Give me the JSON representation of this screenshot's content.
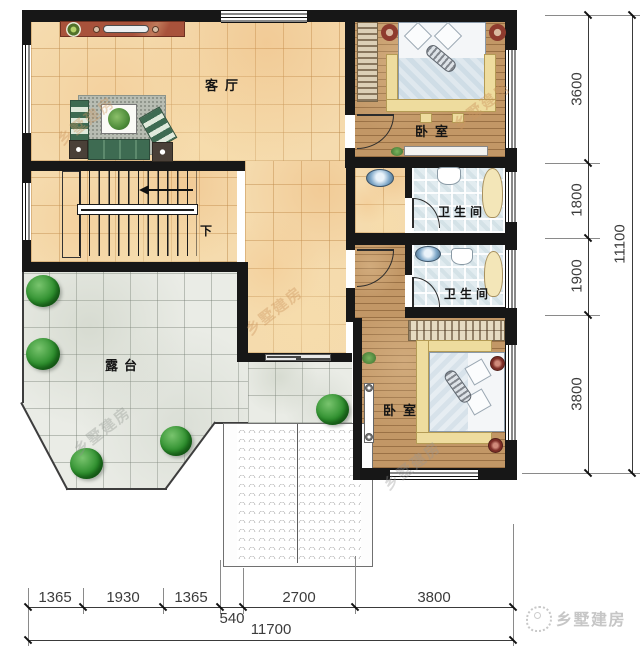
{
  "plan": {
    "rooms": {
      "living_room": "客厅",
      "bedroom_top": "卧室",
      "bathroom_top": "卫生间",
      "bathroom_mid": "卫生间",
      "bedroom_bottom": "卧室",
      "terrace": "露台"
    },
    "stairs": {
      "down_label": "下"
    },
    "dimensions": {
      "bottom": {
        "segments": [
          "1365",
          "1930",
          "1365",
          "540",
          "2700",
          "3800"
        ],
        "total": "11700"
      },
      "right": {
        "segments": [
          "3600",
          "1800",
          "1900",
          "3800"
        ],
        "total": "11100"
      }
    }
  },
  "branding": {
    "watermark_text": "乡墅建房",
    "logo_text": "乡墅建房"
  },
  "colors": {
    "wall": "#171717",
    "tile_floor": "#f5dbae",
    "wood_floor": "#c29766",
    "bath_floor": "#e2ecf0",
    "terrace_floor": "#eaece6",
    "plant_green": "#2e8f2e"
  }
}
